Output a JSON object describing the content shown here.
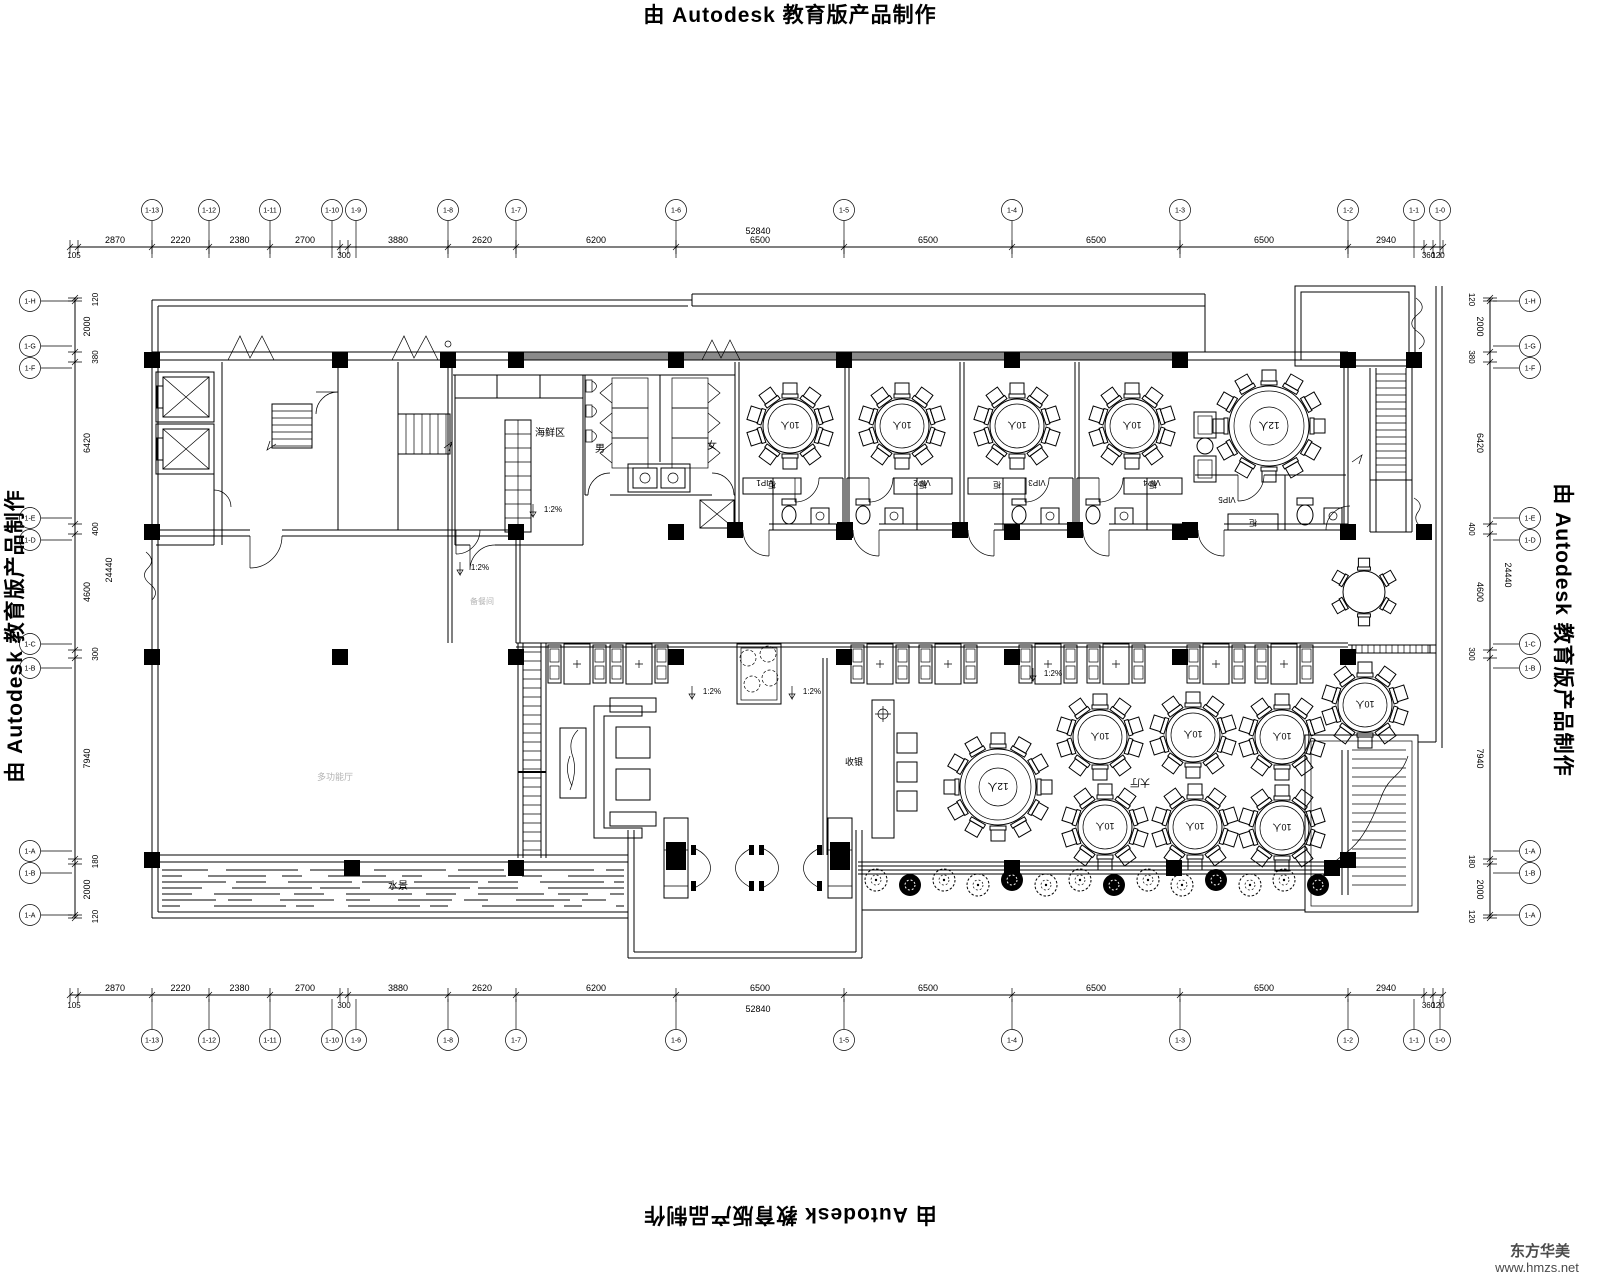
{
  "watermarks": {
    "autodesk": "由 Autodesk 教育版产品制作",
    "brand_name": "东方华美",
    "brand_url": "www.hmzs.net"
  },
  "grid": {
    "top": {
      "total": "52840",
      "segments": [
        "105",
        "2870",
        "2220",
        "2380",
        "2700",
        "300",
        "3880",
        "2620",
        "6200",
        "6500",
        "6500",
        "6500",
        "6500",
        "2940",
        "360",
        "120"
      ],
      "axis_labels": [
        "1-13",
        "1-12",
        "1-11",
        "1-10",
        "1-9",
        "1-8",
        "1-7",
        "1-6",
        "1-5",
        "1-4",
        "1-3",
        "1-2",
        "1-1",
        "1-0"
      ]
    },
    "side": {
      "total": "24440",
      "segments": [
        "120",
        "2000",
        "380",
        "6420",
        "400",
        "4600",
        "300",
        "7940",
        "180",
        "2000",
        "120"
      ],
      "axis_labels": [
        "1-H",
        "1-G",
        "1-F",
        "1-E",
        "1-D",
        "1-C",
        "1-B",
        "1-A",
        "1-B",
        "1-A"
      ]
    }
  },
  "labels": {
    "seafood": "海鲜区",
    "male": "男",
    "female": "女",
    "cashier": "收银",
    "hall": "大厅",
    "main_hall": "多功能厅",
    "pantry": "备餐间",
    "water": "水景",
    "cabinet": "柜",
    "slope": "1:2%",
    "table10": "10人",
    "table12": "12人",
    "vip": [
      "VIP1",
      "VIP2",
      "VIP3",
      "VIP4",
      "VIP5"
    ]
  },
  "furniture": {
    "round_tables": [
      {
        "x": 790,
        "y": 426,
        "r": 27,
        "seats": 10,
        "size": 10
      },
      {
        "x": 902,
        "y": 426,
        "r": 27,
        "seats": 10,
        "size": 10
      },
      {
        "x": 1017,
        "y": 426,
        "r": 27,
        "seats": 10,
        "size": 10
      },
      {
        "x": 1132,
        "y": 426,
        "r": 27,
        "seats": 10,
        "size": 10
      },
      {
        "x": 1269,
        "y": 426,
        "r": 40,
        "seats": 12,
        "size": 12
      },
      {
        "x": 998,
        "y": 787,
        "r": 38,
        "seats": 12,
        "size": 12
      },
      {
        "x": 1100,
        "y": 737,
        "r": 27,
        "seats": 10,
        "size": 10
      },
      {
        "x": 1193,
        "y": 735,
        "r": 27,
        "seats": 10,
        "size": 10
      },
      {
        "x": 1282,
        "y": 737,
        "r": 27,
        "seats": 10,
        "size": 10
      },
      {
        "x": 1105,
        "y": 827,
        "r": 27,
        "seats": 10,
        "size": 10
      },
      {
        "x": 1195,
        "y": 827,
        "r": 27,
        "seats": 10,
        "size": 10
      },
      {
        "x": 1282,
        "y": 828,
        "r": 27,
        "seats": 10,
        "size": 10
      },
      {
        "x": 1365,
        "y": 705,
        "r": 27,
        "seats": 10,
        "size": 10
      },
      {
        "x": 1364,
        "y": 592,
        "r": 21,
        "seats": 6,
        "size": 0
      }
    ],
    "booth_x": [
      577,
      639,
      880,
      948,
      1048,
      1116,
      1216,
      1284
    ],
    "booth_y": 664,
    "columns": [
      [
        152,
        360
      ],
      [
        340,
        360
      ],
      [
        448,
        360
      ],
      [
        516,
        360
      ],
      [
        676,
        360
      ],
      [
        844,
        360
      ],
      [
        1012,
        360
      ],
      [
        1180,
        360
      ],
      [
        1348,
        360
      ],
      [
        1414,
        360
      ],
      [
        152,
        532
      ],
      [
        516,
        532
      ],
      [
        676,
        532
      ],
      [
        844,
        532
      ],
      [
        1012,
        532
      ],
      [
        1180,
        532
      ],
      [
        1348,
        532
      ],
      [
        1424,
        532
      ],
      [
        735,
        530
      ],
      [
        845,
        530
      ],
      [
        960,
        530
      ],
      [
        1075,
        530
      ],
      [
        1190,
        530
      ],
      [
        152,
        657
      ],
      [
        340,
        657
      ],
      [
        516,
        657
      ],
      [
        676,
        657
      ],
      [
        844,
        657
      ],
      [
        1012,
        657
      ],
      [
        1180,
        657
      ],
      [
        1348,
        657
      ],
      [
        152,
        860
      ],
      [
        352,
        868
      ],
      [
        516,
        868
      ],
      [
        1012,
        868
      ],
      [
        1174,
        868
      ],
      [
        1332,
        868
      ],
      [
        1348,
        860
      ]
    ],
    "trees_x": [
      876,
      910,
      944,
      978,
      1012,
      1046,
      1080,
      1114,
      1148,
      1182,
      1216,
      1250,
      1284,
      1318
    ],
    "trees_y": 882,
    "slope_marks": [
      [
        553,
        512
      ],
      [
        480,
        570
      ],
      [
        712,
        694
      ],
      [
        812,
        694
      ],
      [
        1053,
        676
      ]
    ],
    "vip_rooms": [
      {
        "x0": 735,
        "x1": 845,
        "bath": "R"
      },
      {
        "x0": 845,
        "x1": 960,
        "bath": "L"
      },
      {
        "x0": 960,
        "x1": 1075,
        "bath": "R"
      },
      {
        "x0": 1075,
        "x1": 1190,
        "bath": "L"
      }
    ],
    "vip_label_pos": [
      [
        765,
        486
      ],
      [
        922,
        486
      ],
      [
        1037,
        486
      ],
      [
        1152,
        486
      ],
      [
        1227,
        503
      ]
    ]
  }
}
